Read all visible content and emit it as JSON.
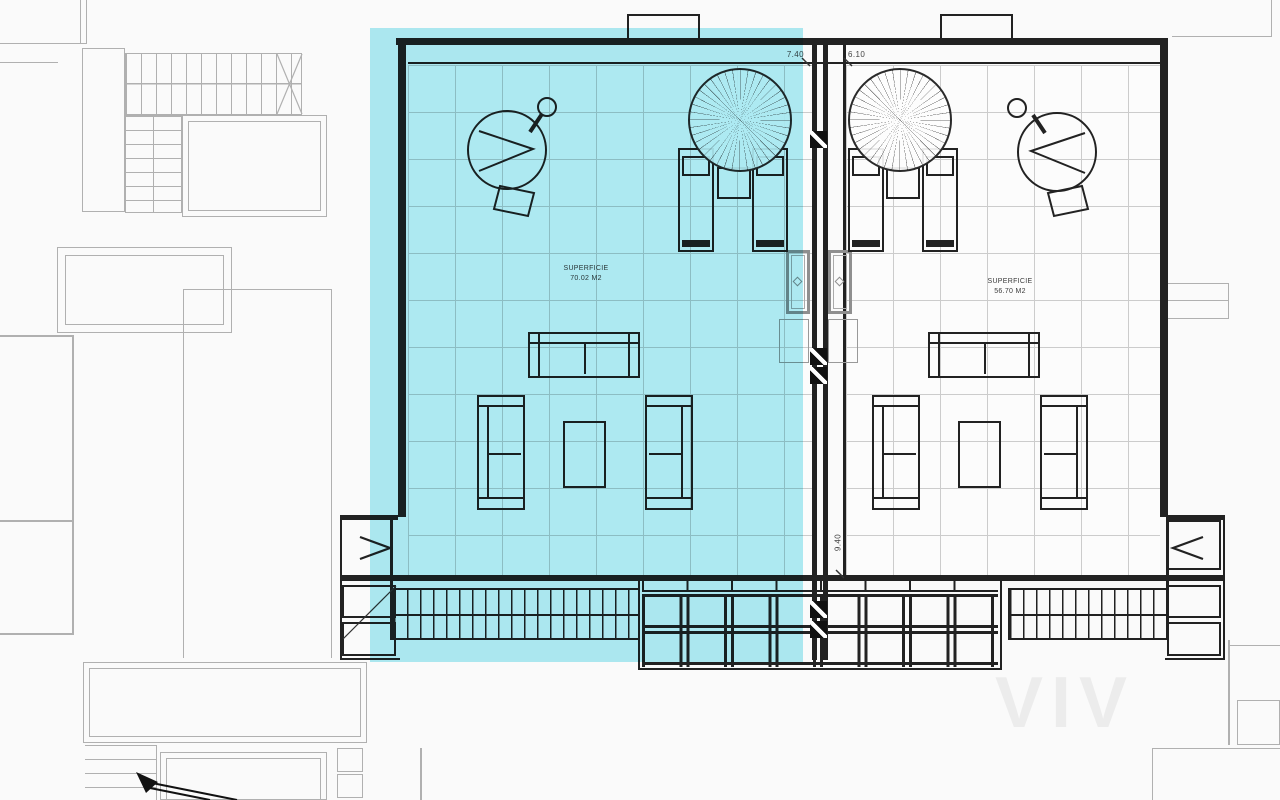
{
  "drawing": {
    "areas": {
      "left": {
        "line1": "SUPERFICIE",
        "line2": "70.02 M2"
      },
      "right": {
        "line1": "SUPERFICIE",
        "line2": "56.70 M2"
      }
    },
    "dimensions": {
      "left_terrace_width": "7.40",
      "right_terrace_width": "6.10",
      "terrace_depth": "9.40"
    },
    "watermark": "VIV"
  },
  "colors": {
    "hl": "#5fd9ea",
    "ink": "#222222",
    "gray": "#b0b0b0",
    "grid": "#cccccc",
    "paper": "#fafafa"
  }
}
